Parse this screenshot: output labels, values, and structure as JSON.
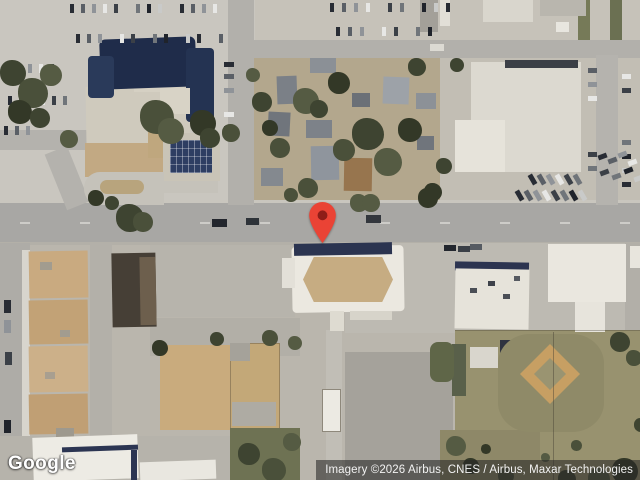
{
  "map": {
    "view_type": "satellite",
    "marker": {
      "label": "location-pin",
      "color": "#EA4335",
      "dot_color": "#8E1D18"
    }
  },
  "overlay": {
    "logo_text": "Google",
    "attribution": "Imagery ©2026 Airbus, CNES / Airbus, Maxar Technologies"
  }
}
